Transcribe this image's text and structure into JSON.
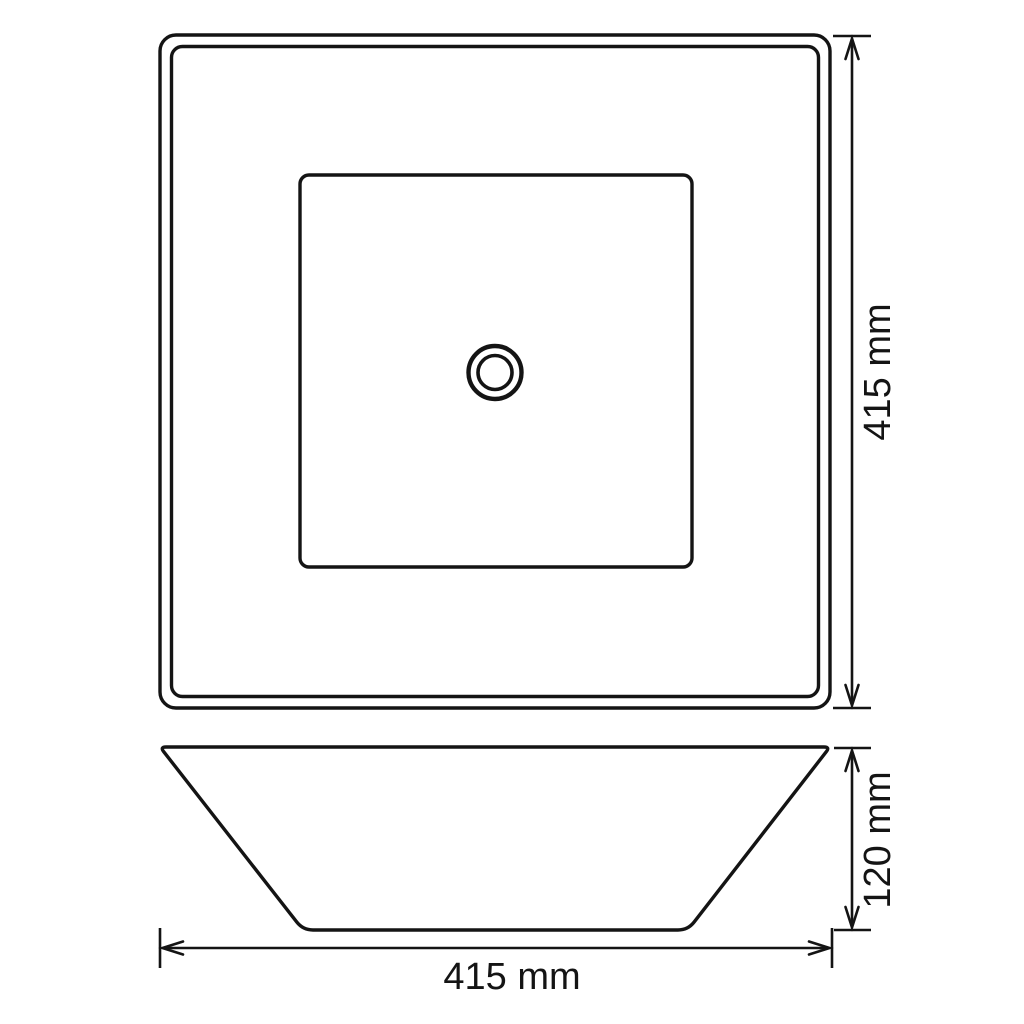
{
  "page": {
    "background": "#ffffff",
    "line_color": "#141414"
  },
  "drawing": {
    "kind": "technical-dimension-drawing",
    "views": {
      "top_view": "square basin plan view with drain hole",
      "side_view": "tapered basin elevation view"
    }
  },
  "dimensions": {
    "top_view_height": {
      "label": "415 mm",
      "value": 415,
      "unit": "mm",
      "orientation": "vertical"
    },
    "side_view_height": {
      "label": "120 mm",
      "value": 120,
      "unit": "mm",
      "orientation": "vertical"
    },
    "side_view_width": {
      "label": "415 mm",
      "value": 415,
      "unit": "mm",
      "orientation": "horizontal"
    }
  }
}
